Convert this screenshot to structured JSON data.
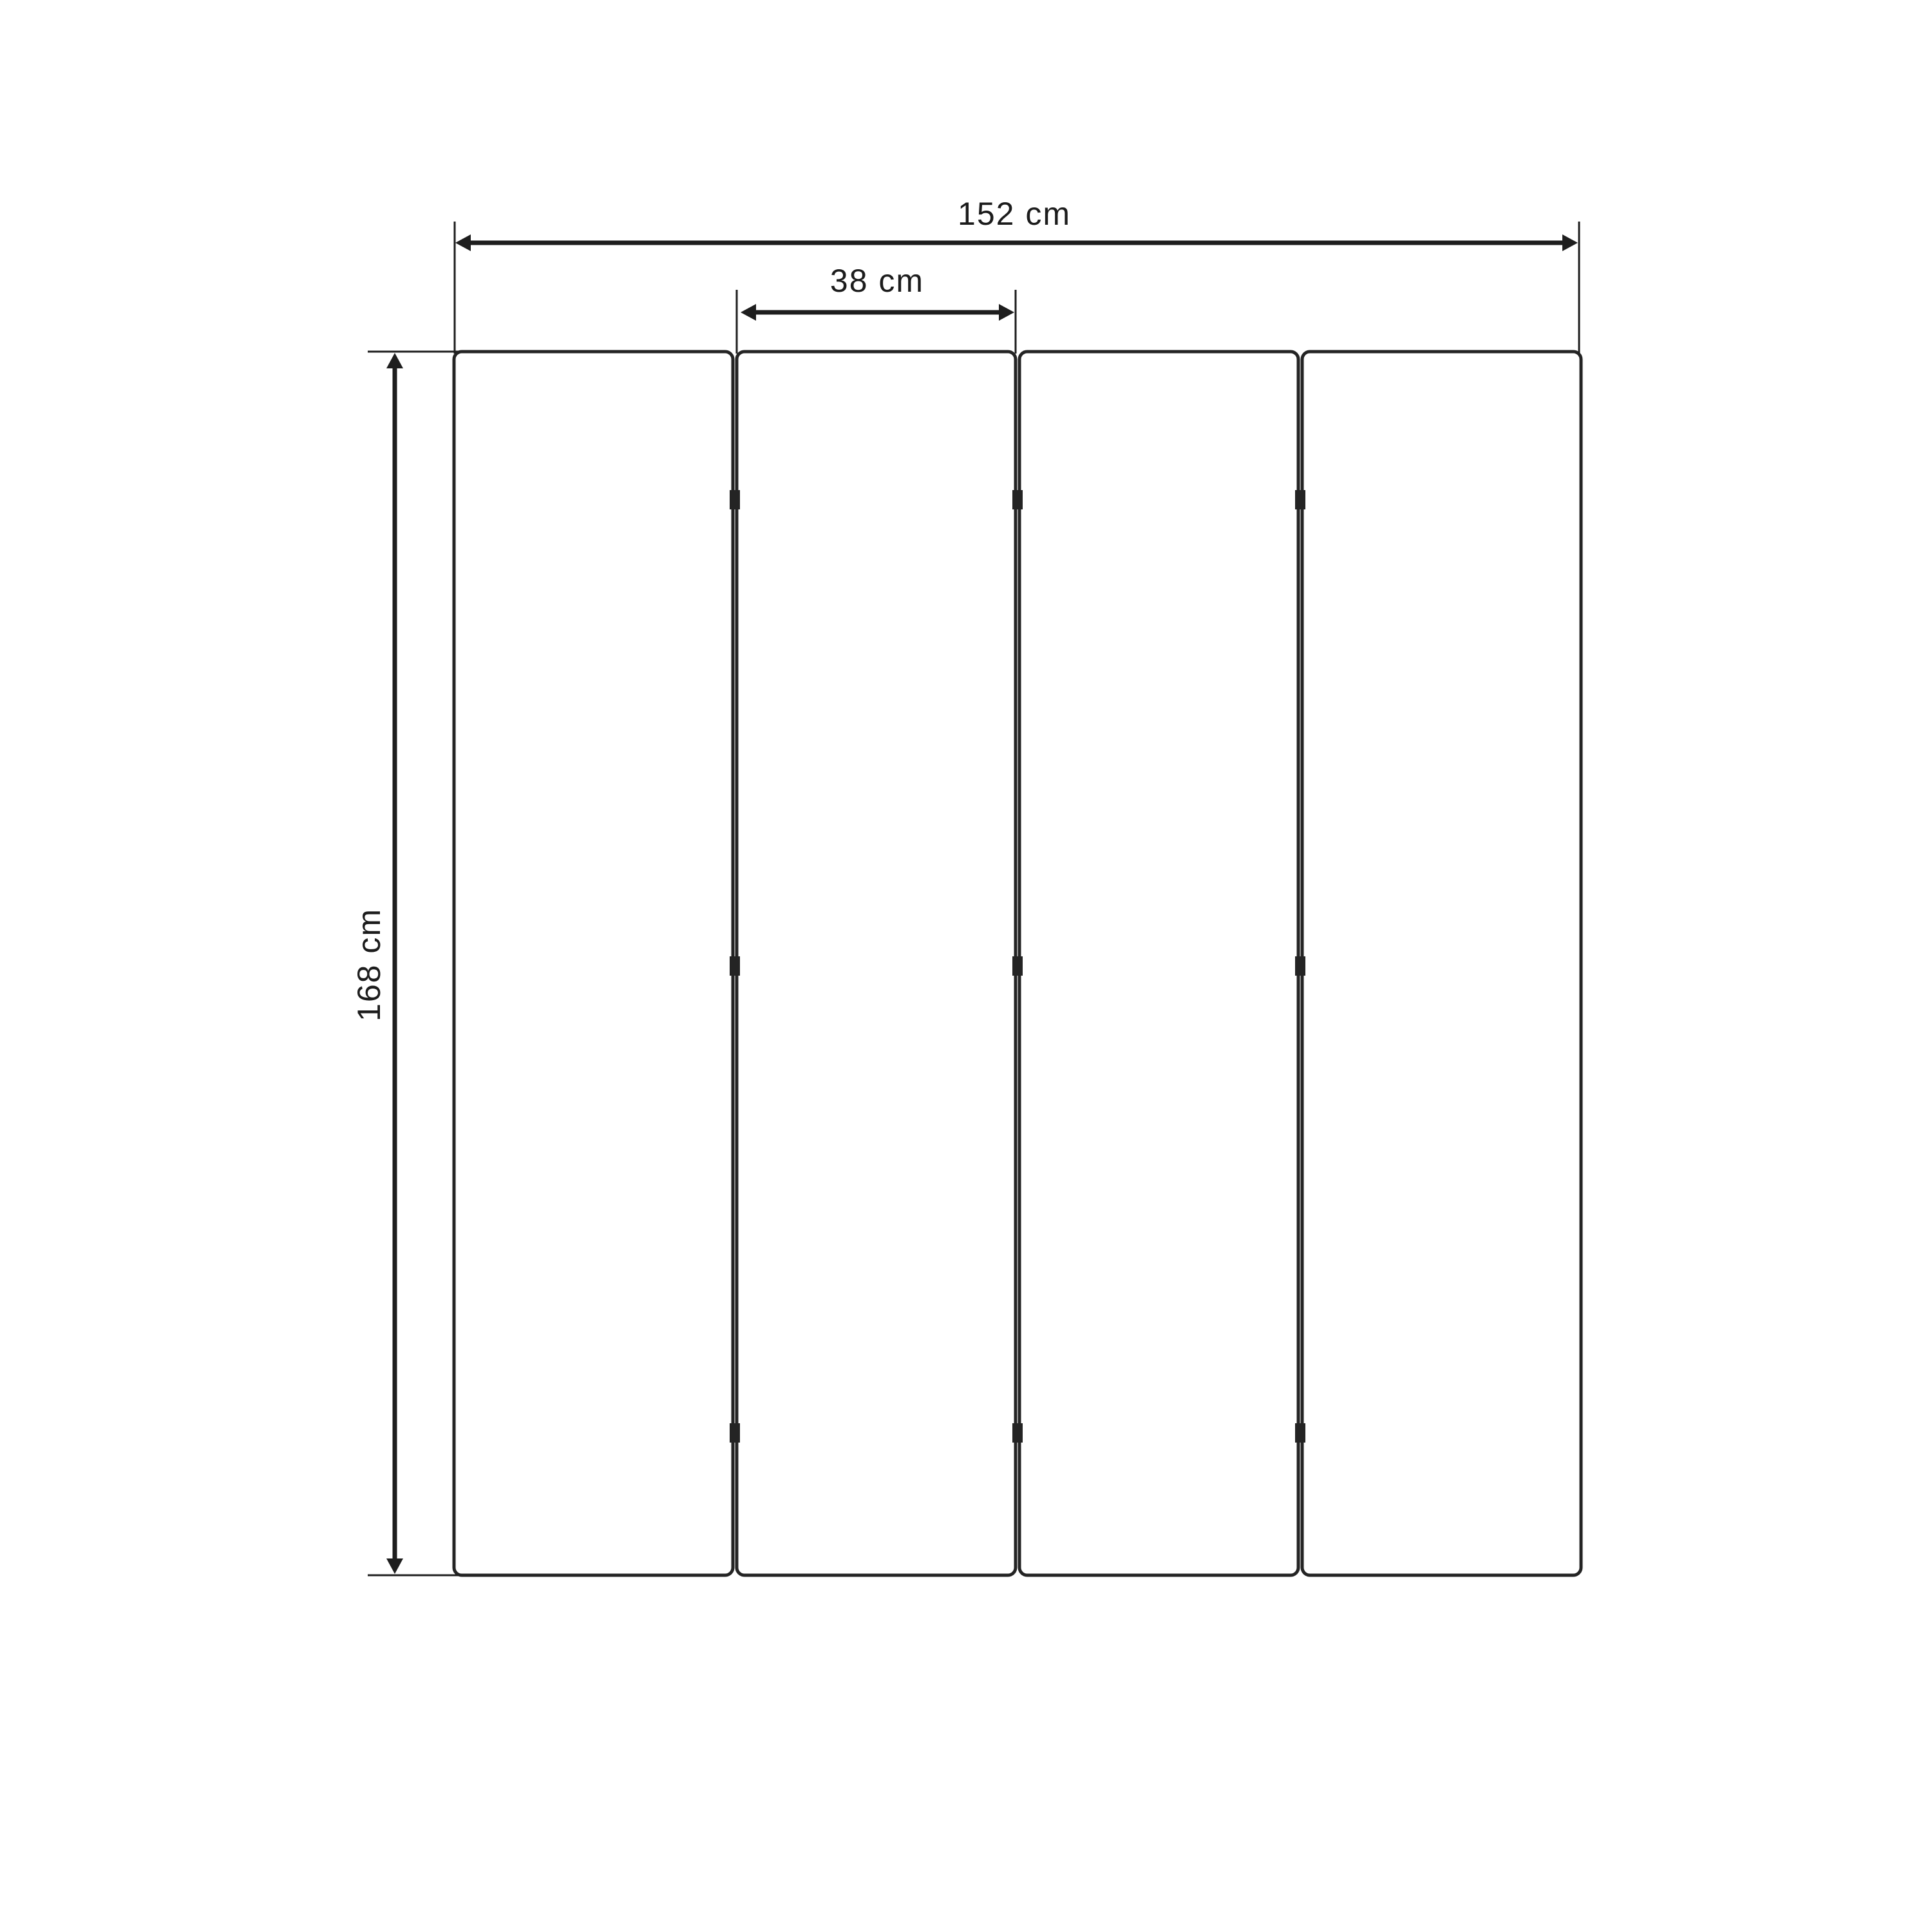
{
  "diagram": {
    "type": "technical-dimension-drawing",
    "subject": "four-panel folding screen, front elevation",
    "background_color": "#ffffff",
    "line_color": "#1e1e1e",
    "panel_border_color": "#242424",
    "panel_count": 4,
    "hinge_gaps": 3,
    "hinges_per_gap": 3,
    "dimensions": {
      "total_width": {
        "label": "152 cm",
        "value": 152,
        "unit": "cm"
      },
      "panel_width": {
        "label": "38 cm",
        "value": 38,
        "unit": "cm"
      },
      "height": {
        "label": "168 cm",
        "value": 168,
        "unit": "cm"
      }
    }
  }
}
